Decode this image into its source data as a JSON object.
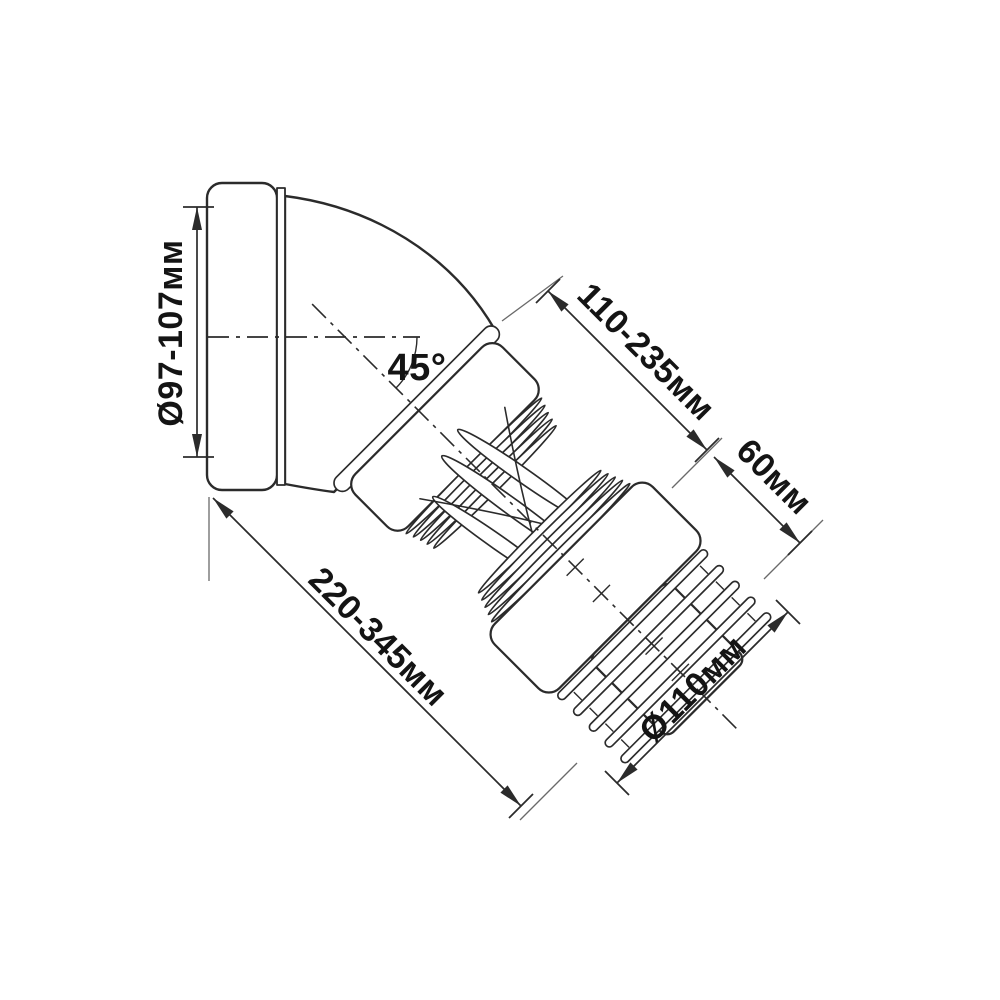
{
  "diagram": {
    "type": "technical-dimension-drawing",
    "subject": "45-degree flexible WC pan connector (corrugated toilet waste pipe)",
    "background_color": "#ffffff",
    "line_color": "#2b2b2b",
    "text_color": "#141414",
    "labels": {
      "inlet_diameter": "Ø97-107мм",
      "bend_angle": "45°",
      "corrugated_length_range": "110-235мм",
      "outlet_spigot_length": "60мм",
      "overall_length_range": "220-345мм",
      "outlet_diameter": "Ø110мм"
    },
    "parts": [
      "inlet rubber cuff",
      "45-degree elbow bend",
      "corrugated flexible hose",
      "outlet sleeve",
      "finned outlet spigot"
    ]
  }
}
